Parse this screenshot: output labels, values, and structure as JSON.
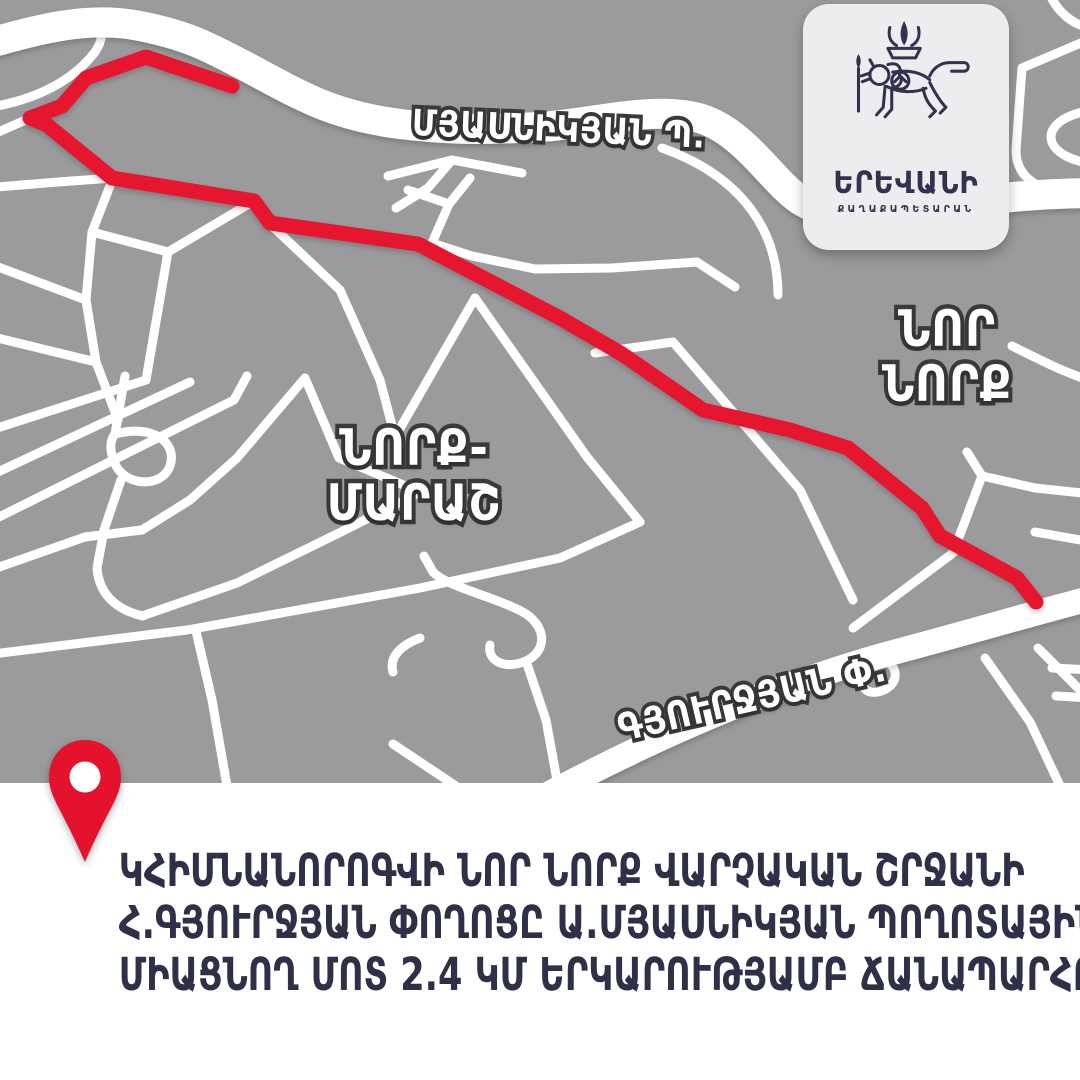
{
  "colors": {
    "map_background": "#9b9b9d",
    "roads": "#ffffff",
    "route": "#e5122d",
    "pin": "#e5122d",
    "label_outline": "#3a3a3c",
    "caption_text": "#2e3047",
    "card_background": "#ededef",
    "logo_navy": "#32324e"
  },
  "logo_card": {
    "city": "ԵՐԵՎԱՆԻ",
    "org": "ՔԱՂԱՔԱՊԵՏԱՐԱՆ",
    "emblem": "yerevan-lion-coat-of-arms"
  },
  "map": {
    "street_labels": {
      "myasnikyan": "ՄՅԱՍՆԻԿՅԱՆ Պ.",
      "gyurjyan": "ԳՅՈՒՐՋՅԱՆ Փ."
    },
    "districts": {
      "nor_nork": [
        "ՆՈՐ",
        "ՆՈՐՔ"
      ],
      "nork_marash": [
        "ՆՈՐՔ-",
        "ՄԱՐԱՇ"
      ]
    },
    "route": {
      "description": "highlighted road section, H. Gyurjyan street to A. Myasnikyan avenue",
      "length": "2.4 ԿՄ"
    },
    "marker": "location-pin"
  },
  "caption": {
    "lines": [
      "ԿՀԻՄՆԱՆՈՐՈԳՎԻ ՆՈՐ ՆՈՐՔ ՎԱՐՉԱԿԱՆ ՇՐՋԱՆԻ",
      "Հ.ԳՅՈՒՐՋՅԱՆ ՓՈՂՈՑԸ Ա.ՄՅԱՍՆԻԿՅԱՆ ՊՈՂՈՏԱՅԻՆ",
      "ՄԻԱՑՆՈՂ ՄՈՏ 2.4 ԿՄ ԵՐԿԱՐՈՒԹՅԱՄԲ ՃԱՆԱՊԱՐՀԸ"
    ]
  }
}
